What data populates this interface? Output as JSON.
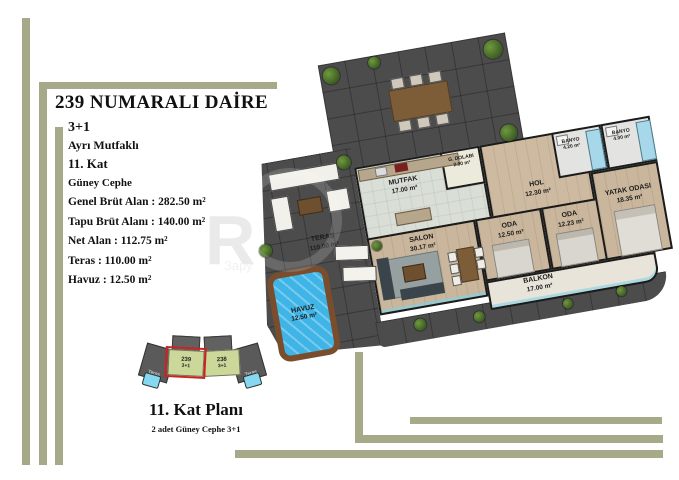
{
  "title": "239 NUMARALI DAİRE",
  "unit": {
    "type": "3+1",
    "kitchen": "Ayrı Mutfaklı",
    "floor": "11. Kat",
    "facade": "Güney Cephe"
  },
  "areas": {
    "sep": " :  ",
    "items": [
      {
        "label": "Genel Brüt Alan",
        "value": "282.50 m²"
      },
      {
        "label": "Tapu Brüt Alanı",
        "value": "140.00 m²"
      },
      {
        "label": "Net Alan",
        "value": "112.75 m²"
      },
      {
        "label": "Teras",
        "value": "110.00 m²"
      },
      {
        "label": "Havuz",
        "value": "12.50 m²"
      }
    ]
  },
  "plan": {
    "rooms": {
      "mutfak": {
        "name": "MUTFAK",
        "area": "17.00 m²"
      },
      "dolap": {
        "name": "G. DOLABI",
        "area": "2.00 m²"
      },
      "hol": {
        "name": "HOL",
        "area": "12.30 m²"
      },
      "banyo1": {
        "name": "BANYO",
        "area": "4.20 m²"
      },
      "banyo2": {
        "name": "BANYO",
        "area": "4.00 m²"
      },
      "yatak": {
        "name": "YATAK ODASI",
        "area": "18.35 m²"
      },
      "oda1": {
        "name": "ODA",
        "area": "12.50 m²"
      },
      "oda2": {
        "name": "ODA",
        "area": "12.23 m²"
      },
      "salon": {
        "name": "SALON",
        "area": "30.17 m²"
      },
      "balkon": {
        "name": "BALKON",
        "area": "17.00 m²"
      },
      "teras": {
        "name": "TERAS",
        "area": "110.00 m²"
      },
      "havuz": {
        "name": "HAVUZ",
        "area": "12.50 m²"
      }
    }
  },
  "key_plan": {
    "units": [
      {
        "no": "239",
        "type": "3+1",
        "highlighted": true
      },
      {
        "no": "238",
        "type": "3+1",
        "highlighted": false
      }
    ],
    "wing_label": "Teras",
    "caption": "11. Kat Planı",
    "subcaption": "2 adet Güney Cephe 3+1"
  },
  "watermark": {
    "letter": "R",
    "text": "Зару"
  },
  "colors": {
    "accent_bar": "#a6aa88",
    "terrace_dark": "#4c4c4c",
    "pool_water": "#3fb4e6",
    "pool_deck": "#7a4e2c",
    "key_unit_fill": "#cbd89a",
    "key_highlight": "#d02020"
  }
}
